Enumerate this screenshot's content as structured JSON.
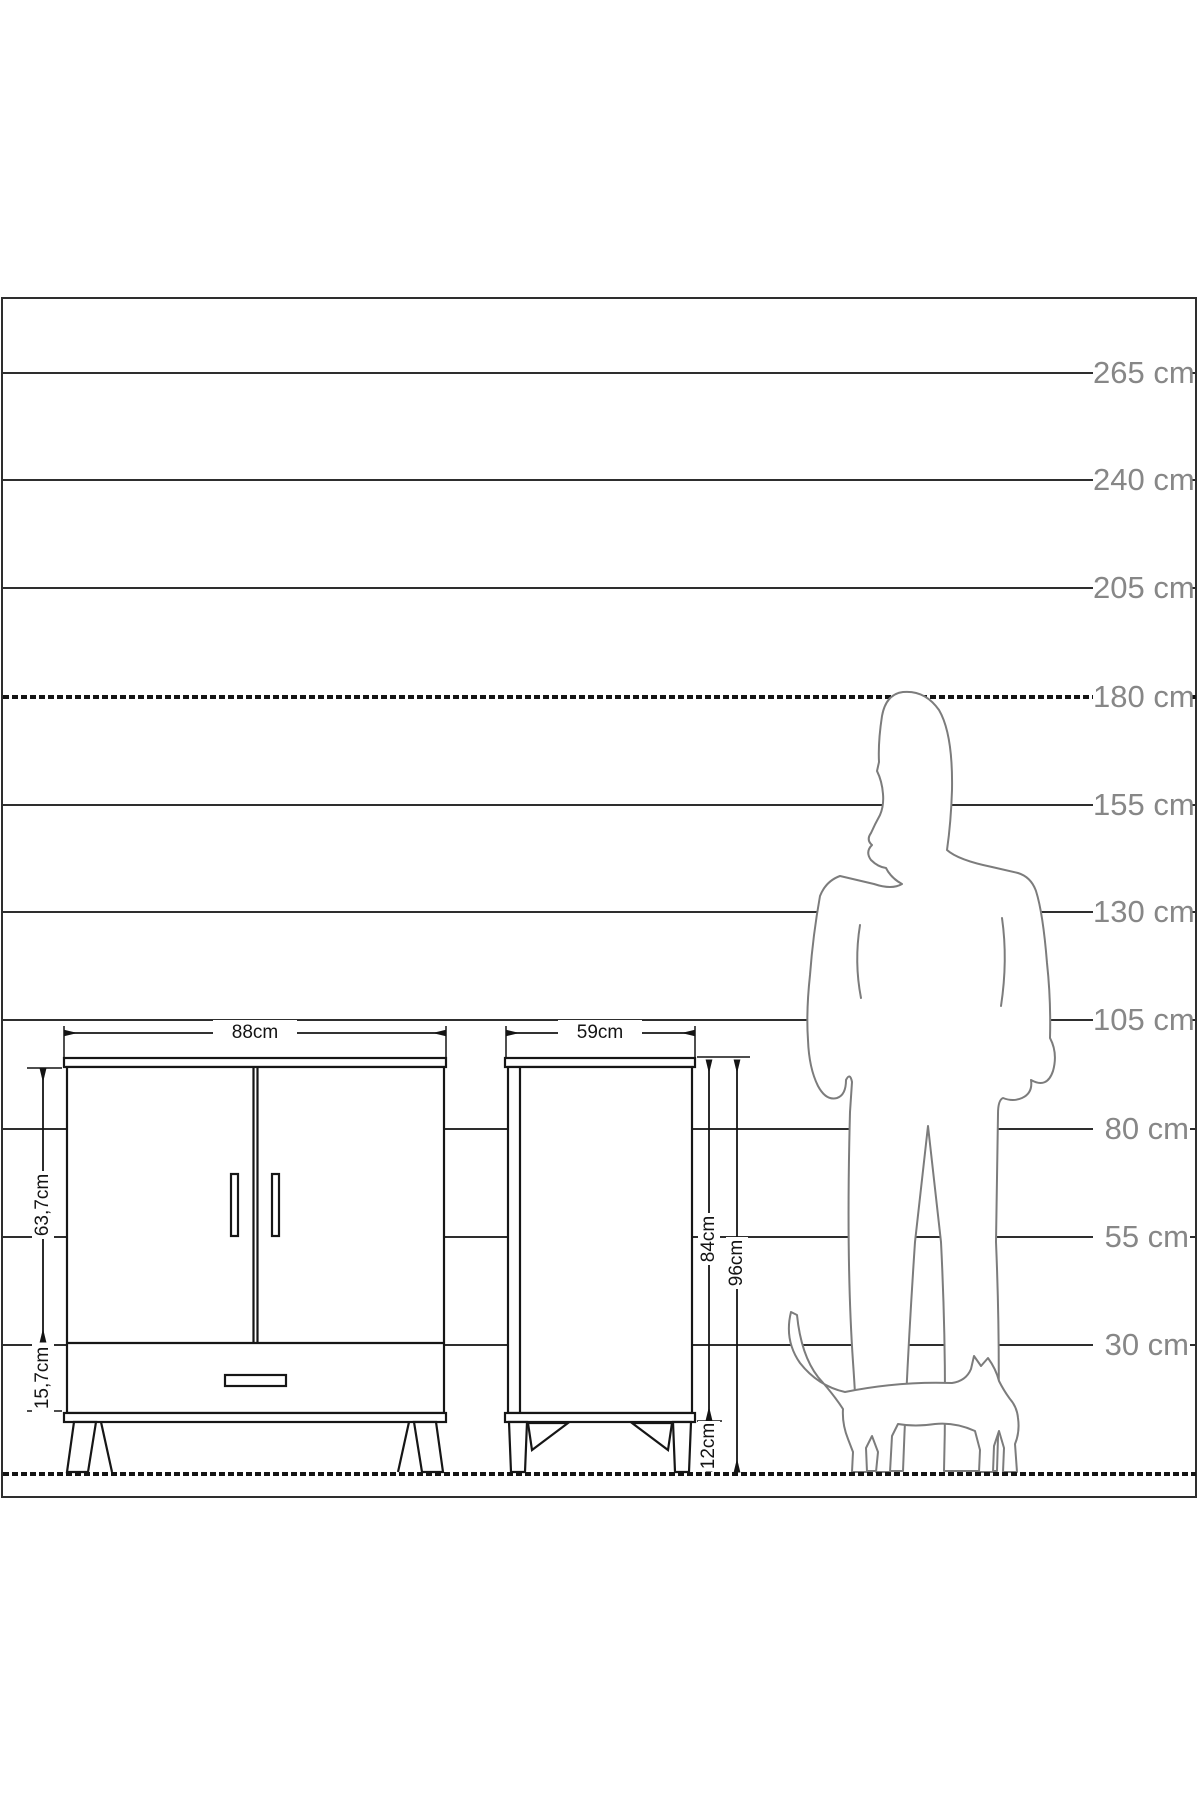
{
  "diagram": {
    "unit": "cm",
    "scale_labels": [
      "265 cm",
      "240 cm",
      "205 cm",
      "180 cm",
      "155 cm",
      "130 cm",
      "105 cm",
      "80 cm",
      "55 cm",
      "30 cm"
    ],
    "scale_values_cm": [
      265,
      240,
      205,
      180,
      155,
      130,
      105,
      80,
      55,
      30
    ],
    "reference_line_cm": 180,
    "furniture": {
      "front_view": {
        "width_label": "88cm",
        "door_height_label": "63,7cm",
        "drawer_height_label": "15,7cm"
      },
      "side_view": {
        "depth_label": "59cm",
        "body_height_label": "84cm",
        "total_height_label": "96cm",
        "leg_height_label": "12cm"
      }
    },
    "silhouettes": [
      "man-silhouette",
      "cat-silhouette"
    ],
    "colors": {
      "background": "#ffffff",
      "grid_line": "#2e2e2e",
      "furniture_line": "#161616",
      "silhouette_line": "#7c7c7c",
      "scale_text": "#878787",
      "dimension_text": "#141414"
    }
  }
}
